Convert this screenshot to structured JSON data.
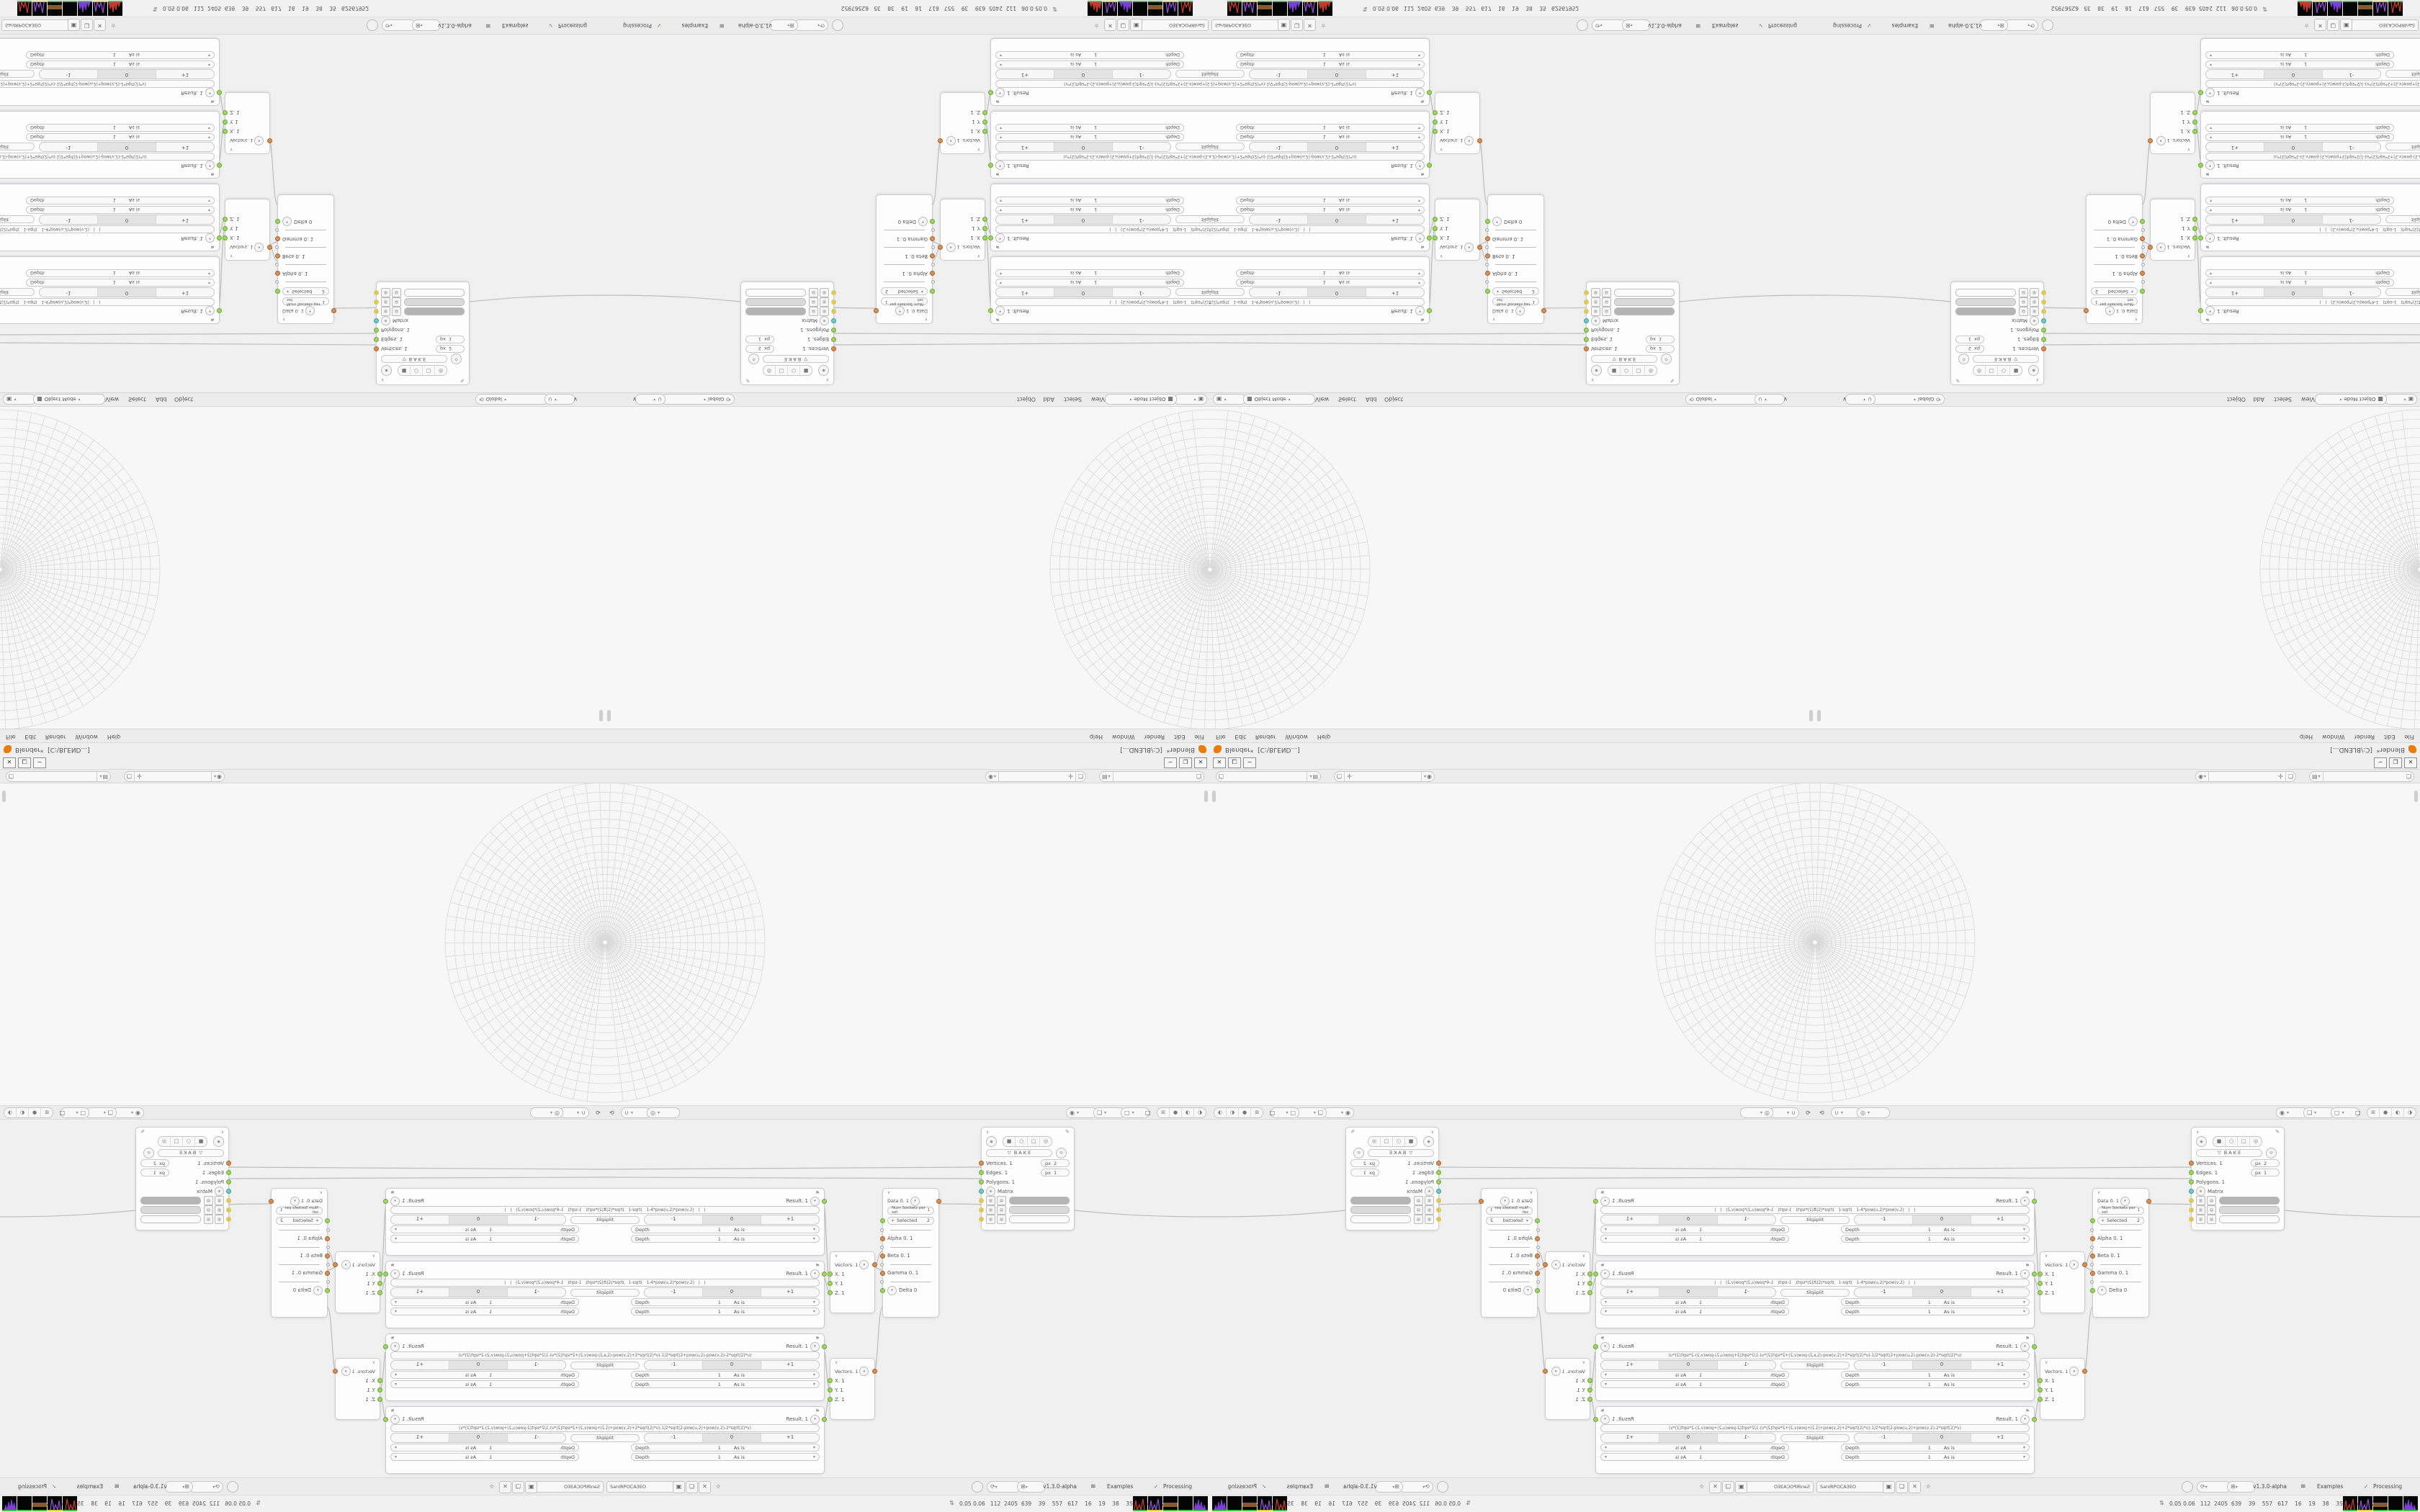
{
  "window": {
    "title": "Blender*  [C:\\BLEND...]",
    "minimize": "─",
    "maximize": "❐",
    "close": "✕"
  },
  "topbar": {
    "menus": [
      "File",
      "Edit",
      "Render",
      "Window",
      "Help"
    ],
    "scene_field": "",
    "viewlayer_field": ""
  },
  "icons": {
    "caret_down": "▾",
    "chevron_down": "∨",
    "chevron_up": "∧",
    "collapse": "∨",
    "person": "◉",
    "image": "▤",
    "pin": "✛",
    "copy": "❏",
    "close_x": "✕",
    "shield": "▣",
    "orbit": "⟲",
    "refresh": "⟳",
    "snap": "∪",
    "proportional": "◎",
    "gizmo": "◉",
    "overlay": "❏",
    "xray": "□",
    "shade_wire": "⊞",
    "shade_solid": "●",
    "shade_material": "◐",
    "shade_render": "◑",
    "eye": "◉",
    "cube": "■",
    "circle": "○",
    "square": "□",
    "cyl": "◎",
    "funnel": "▽",
    "id": "◎",
    "pencil": "✎",
    "matrix_plus": "⊕",
    "flag": "⚑",
    "dna": "≋",
    "check": "✓",
    "stats": "⇅",
    "star": "☆",
    "grid_small": "▥",
    "bars_small": "▤"
  },
  "viewport_header_top": {
    "editor_icon_label": "▣",
    "mode": "Object Mode",
    "menus": [
      "View",
      "Select",
      "Add",
      "Object"
    ],
    "orientation": "Global"
  },
  "node_editor": {
    "tree_name": "SanIRPOCA3EO",
    "version": "v1.3.0-alpha",
    "examples": "Examples",
    "processing": "Processing",
    "formula_nodes": [
      {
        "result": "Result. 1",
        "formula": "(u*v)/v*sqrt(2)*sqrt(   1-sqrt(   1-4*pow(u,2)*pow(v,2)   )   )",
        "split": "Split",
        "minus": "-1",
        "zero": "0",
        "plus": "+1",
        "depth": "Depth",
        "depth_val": "1",
        "asis": "As is"
      },
      {
        "result": "Result. 1",
        "formula": "(u*v)/u*sqrt(2)*sqrt(   1-sqrt(   1-4*pow(u,2)*pow(v,2)   )   )",
        "split": "Split",
        "minus": "-1",
        "zero": "0",
        "plus": "+1",
        "depth": "Depth",
        "depth_val": "1",
        "asis": "As is"
      },
      {
        "result": "Result. 1",
        "formula": "rt(2+pow(u,2)-pow(v,2)+2*sqrt(2)*u)-1/2*sqrt(2+pow(u,2)-pow(v,2)-2*sqrt(2)*u)",
        "split": "Split",
        "minus": "-1",
        "zero": "0",
        "plus": "+1",
        "depth": "Depth",
        "depth_val": "1",
        "asis": "As is"
      },
      {
        "result": "Result. 1",
        "formula": "rt(2-pow(u,2)+pow(v,2)+2*sqrt(2)*v)-1/2*sqrt(2-pow(u,2)+pow(v,2)-2*sqrt(2)*v)",
        "split": "Split",
        "minus": "-1",
        "zero": "0",
        "plus": "+1",
        "depth": "Depth",
        "depth_val": "1",
        "asis": "As is"
      }
    ],
    "vector_nodes": [
      {
        "label": "Vectors. 1",
        "x": "X. 1",
        "y": "Y. 1",
        "z": "Z. 1"
      },
      {
        "label": "Vectors. 1",
        "x": "X. 1",
        "y": "Y. 1",
        "z": "Z. 1"
      }
    ],
    "data_node": {
      "output": "Data 0. 1",
      "num_sockets": "Num Sockets per set",
      "num_val": "1",
      "selected": "Selected",
      "selected_val": "2",
      "alpha": "Alpha 0. 1",
      "beta": "Beta 0. 1",
      "gamma": "Gamma 0. 1",
      "delta": "Delta 0"
    },
    "viewer_node": {
      "bake": "B A K E",
      "vertices": "Vertices. 1",
      "vertices_px": "px",
      "vertices_val": "2",
      "edges": "Edges. 1",
      "edges_px": "px",
      "edges_val": "1",
      "polygons": "Polygons. 1",
      "matrix": "Matrix",
      "swatches": [
        "#b4b4b4",
        "#d9d9d9",
        "#fbfbfb"
      ]
    },
    "wires": [
      [
        0,
        574,
        522,
        571
      ],
      [
        0,
        585,
        522,
        587
      ],
      [
        303,
        622,
        312,
        731
      ],
      [
        303,
        724,
        312,
        744
      ],
      [
        303,
        824,
        312,
        879
      ],
      [
        303,
        924,
        312,
        892
      ],
      [
        373,
        710,
        385,
        688
      ],
      [
        373,
        710,
        385,
        714
      ],
      [
        373,
        858,
        385,
        766
      ],
      [
        462,
        622,
        840,
        640
      ]
    ]
  },
  "status": {
    "numbers": "0.05 0.06   112  2405  639    39    557   617    16    19    38    35   62567952",
    "tiles": [
      {
        "type": "spikes",
        "color": "#c23b2e",
        "strip": "#46c04a"
      },
      {
        "type": "spikes",
        "color": "#8a4fd0",
        "strip": "#e0d23f"
      },
      {
        "type": "band",
        "color": "#8a5a2e",
        "strip": "#46c04a"
      },
      {
        "type": "plain",
        "color": "#000000",
        "strip": "#46c04a"
      },
      {
        "type": "hist",
        "color": "#7b3fd4",
        "strip": "#46c04a"
      },
      {
        "type": "spikes",
        "color": "#8a4fd0",
        "strip": "#e0d23f"
      },
      {
        "type": "hist",
        "color": "#c23b2e",
        "strip": "#46c04a"
      }
    ]
  }
}
